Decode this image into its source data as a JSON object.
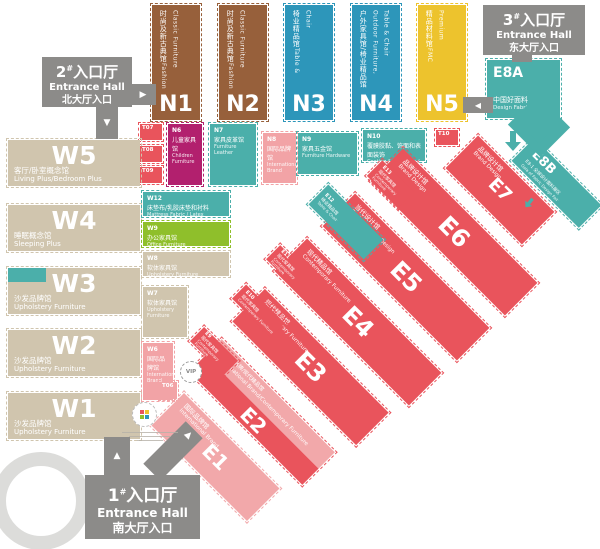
{
  "palette": {
    "brown": "#97603b",
    "blue": "#2d96ba",
    "yellow": "#edc32d",
    "teal": "#4bafaa",
    "magenta": "#b2206e",
    "pink": "#f2a3a6",
    "red": "#e9545c",
    "lightpink": "#f2a8aa",
    "green": "#8fbf2b",
    "tan": "#d0c5ae",
    "gray": "#8c8b89"
  },
  "entrances": {
    "north": {
      "num": "2",
      "sup": "#",
      "word": "入口厅",
      "en": "Entrance Hall",
      "zh": "北大厅入口"
    },
    "east": {
      "num": "3",
      "sup": "#",
      "word": "入口厅",
      "en": "Entrance Hall",
      "zh": "东大厅入口"
    },
    "south": {
      "num": "1",
      "sup": "#",
      "word": "入口厅",
      "en": "Entrance Hall",
      "zh": "南大厅入口"
    }
  },
  "vip_label": "VIP",
  "halls": [
    {
      "id": "n1",
      "code": "N1",
      "zh": "时尚及新古典馆",
      "en": "Fashion Classic Furniture",
      "color": "brown"
    },
    {
      "id": "n2",
      "code": "N2",
      "zh": "时尚及新古典馆",
      "en": "Fashion Classic Furniture",
      "color": "brown"
    },
    {
      "id": "n3",
      "code": "N3",
      "zh": "椅业精品馆",
      "en": "Table & Chair",
      "color": "blue"
    },
    {
      "id": "n4",
      "code": "N4",
      "zh": "户外家具馆/椅业精品馆",
      "en": "Outdoor Furniture, Table & Chair",
      "color": "blue"
    },
    {
      "id": "n5",
      "code": "N5",
      "zh": "精品材料馆",
      "en": "FMC Premium",
      "color": "yellow"
    },
    {
      "id": "t07",
      "code": "T07",
      "zh": "",
      "en": "",
      "color": "red"
    },
    {
      "id": "t08",
      "code": "T08",
      "zh": "",
      "en": "",
      "color": "red"
    },
    {
      "id": "t09",
      "code": "T09",
      "zh": "",
      "en": "",
      "color": "red"
    },
    {
      "id": "t10",
      "code": "T10",
      "zh": "",
      "en": "",
      "color": "red"
    },
    {
      "id": "n6",
      "code": "N6",
      "zh": "儿童家具馆",
      "en": "Children Furniture",
      "color": "magenta"
    },
    {
      "id": "n7",
      "code": "N7",
      "zh": "家具皮革馆",
      "en": "Furniture Leather",
      "color": "teal"
    },
    {
      "id": "n8",
      "code": "N8",
      "zh": "国际品牌馆",
      "en": "International Brand",
      "color": "pink"
    },
    {
      "id": "n9",
      "code": "N9",
      "zh": "家具五金馆",
      "en": "Furniture Hardware",
      "color": "teal"
    },
    {
      "id": "n10",
      "code": "N10",
      "zh": "覆膜胶黏、饰面和表面装饰",
      "en": "Coating & Adhesive / Panels & Surface Décor",
      "color": "teal"
    },
    {
      "id": "w5",
      "code": "W5",
      "zh": "客厅/卧室概念馆",
      "en": "Living Plus/Bedroom Plus",
      "color": "tan"
    },
    {
      "id": "w4",
      "code": "W4",
      "zh": "睡眠概念馆",
      "en": "Sleeping Plus",
      "color": "tan"
    },
    {
      "id": "w3",
      "code": "W3",
      "zh": "沙发品牌馆",
      "en": "Upholstery Furniture",
      "color": "tan"
    },
    {
      "id": "w2",
      "code": "W2",
      "zh": "沙发品牌馆",
      "en": "Upholstery Furniture",
      "color": "tan"
    },
    {
      "id": "w1",
      "code": "W1",
      "zh": "沙发品牌馆",
      "en": "Upholstery Furniture",
      "color": "tan"
    },
    {
      "id": "w12",
      "code": "W12",
      "zh": "床垫布/乳胶床垫和衬料",
      "en": "Mattress Fabric / Latex Household / Materials",
      "color": "teal"
    },
    {
      "id": "w9",
      "code": "W9",
      "zh": "办公家具馆",
      "en": "Office Furniture",
      "color": "green"
    },
    {
      "id": "w8",
      "code": "W8",
      "zh": "软体家具馆",
      "en": "Upholstery Furniture",
      "color": "tan"
    },
    {
      "id": "w7",
      "code": "W7",
      "zh": "软体家具馆",
      "en": "Upholstery Furniture",
      "color": "tan"
    },
    {
      "id": "w6",
      "code": "W6",
      "zh": "国际品牌馆",
      "en": "International Brand",
      "color": "pink"
    },
    {
      "id": "t06",
      "code": "T06",
      "zh": "",
      "en": "",
      "color": "pink"
    },
    {
      "id": "e8a",
      "code": "E8A",
      "zh": "中国好面料",
      "en": "Design Fabric",
      "color": "teal"
    },
    {
      "id": "e8b",
      "code": "E8B",
      "zh": "E8-1 全球设计面料展区",
      "en": "Gala of Fabric Design Fair",
      "color": "teal"
    },
    {
      "id": "e1",
      "code": "E1",
      "zh": "国际品牌馆",
      "en": "International Brand",
      "color": "lightpink"
    },
    {
      "id": "e2",
      "code": "E2",
      "zh": "国际品牌/现代精品馆",
      "en": "International Brand/Contemporary Furniture",
      "color": "red"
    },
    {
      "id": "e3",
      "code": "E3",
      "zh": "现代精品馆",
      "en": "Contemporary Furniture",
      "color": "red"
    },
    {
      "id": "e4",
      "code": "E4",
      "zh": "现代精品馆",
      "en": "Contemporary Furniture",
      "color": "red"
    },
    {
      "id": "e5",
      "code": "E5",
      "zh": "当代设计馆",
      "en": "Contemporary Design",
      "color": "red"
    },
    {
      "id": "e6",
      "code": "E6",
      "zh": "品牌设计馆",
      "en": "Brand Design",
      "color": "red"
    },
    {
      "id": "e7",
      "code": "E7",
      "zh": "品牌设计馆",
      "en": "Brand Design",
      "color": "red"
    },
    {
      "id": "e9",
      "code": "E9",
      "zh": "现代家具馆",
      "en": "Contemporary Furniture",
      "color": "red"
    },
    {
      "id": "e10",
      "code": "E10",
      "zh": "现代家具馆",
      "en": "Contemporary Furniture",
      "color": "red"
    },
    {
      "id": "e11",
      "code": "E11",
      "zh": "现代家具馆",
      "en": "Contemporary Furniture",
      "color": "red"
    },
    {
      "id": "e12",
      "code": "E12",
      "zh": "椅业精品馆",
      "en": "Table & Chair",
      "color": "teal"
    },
    {
      "id": "e13",
      "code": "E13",
      "zh": "现代家具馆",
      "en": "Contemporary Furniture",
      "color": "red"
    }
  ]
}
